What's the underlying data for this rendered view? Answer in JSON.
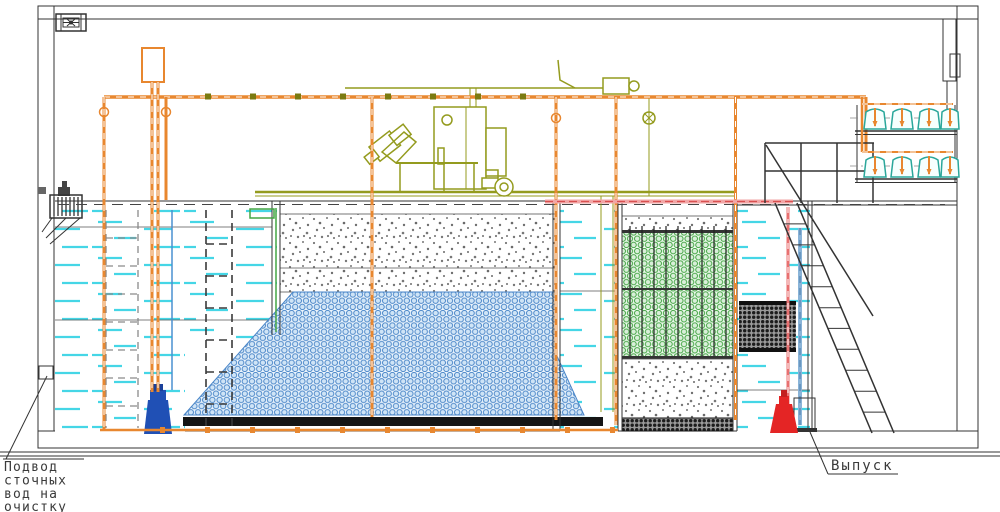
{
  "drawing": {
    "labels": {
      "inlet_lines": [
        "Подвод",
        "сточных",
        "вод на",
        "очистку"
      ],
      "outlet": "Выпуск"
    }
  },
  "colors": {
    "pipe-orange": "#e8872f",
    "equip-olive": "#949b1e",
    "water-cyan": "#45d6e6",
    "media-blue": "#4a86c8",
    "media-green": "#43a543",
    "pump-blue": "#2050b5",
    "pump-red": "#e42525",
    "pipe-pink": "#e87070",
    "pipe-lightblue": "#8ab4d8",
    "blower-teal": "#2aa79b",
    "line-dark": "#333333",
    "hatch-gray": "#666666",
    "text-gray": "#3a3a3a"
  }
}
